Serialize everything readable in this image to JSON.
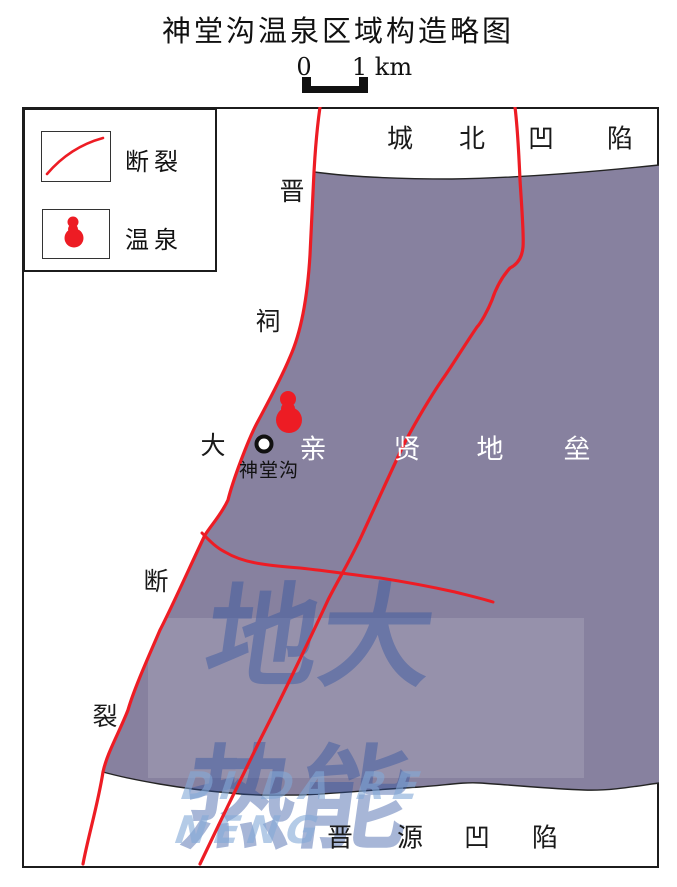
{
  "title": "神堂沟温泉区域构造略图",
  "scale_bar": {
    "zero_label": "0",
    "distance_label": "1 km"
  },
  "legend": {
    "fault_label": "断裂",
    "spring_label": "温泉"
  },
  "map": {
    "north_depression_chars": [
      "城",
      "北",
      "凹",
      "陷"
    ],
    "fault_name_chars": [
      "晋",
      "祠",
      "大",
      "断",
      "裂"
    ],
    "horst_chars": [
      "亲",
      "贤",
      "地",
      "垒"
    ],
    "south_depression_chars": [
      "晋",
      "源",
      "凹",
      "陷"
    ],
    "spring_site_label": "神堂沟"
  },
  "watermark": {
    "cn": "地大热能",
    "latin": "DI DA RE NENG"
  },
  "colors": {
    "horst_purple": "#87819f",
    "fault_red": "#ed1c24",
    "boundary_black": "#242424",
    "watermark_blue": "rgba(45,80,160,0.42)",
    "watermark_latin_blue": "rgba(130,168,215,0.60)"
  }
}
